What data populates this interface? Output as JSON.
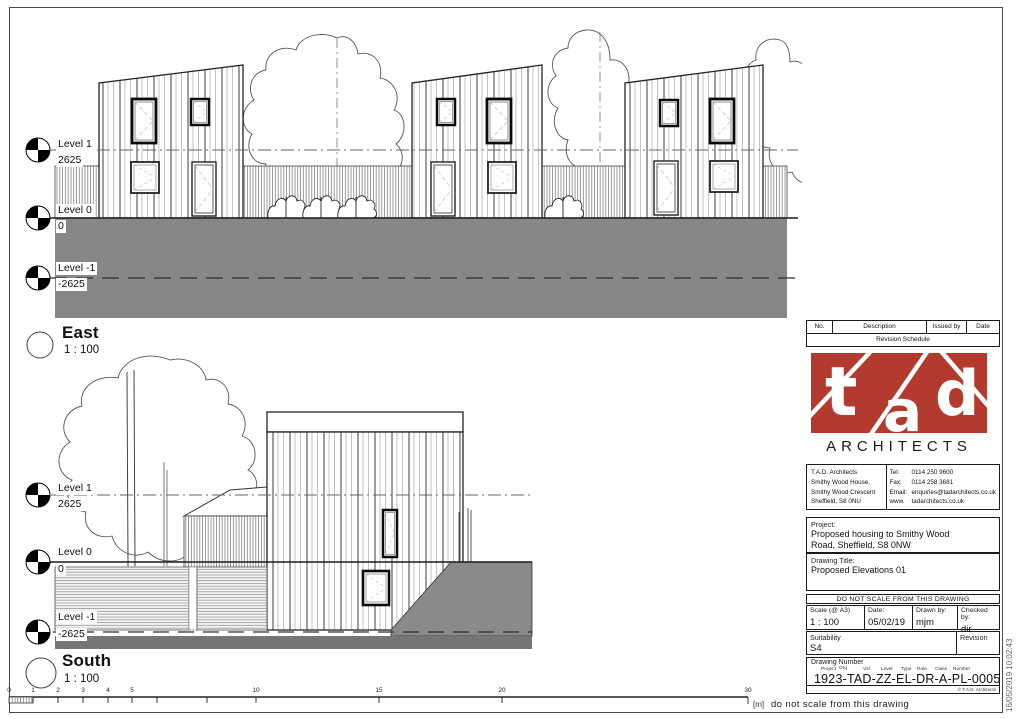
{
  "page": {
    "frame_note_unit": "[m]",
    "frame_note": "do not scale from this drawing",
    "timestamp": "16/05/2019 10:02:43"
  },
  "scalebar": {
    "labels": [
      "0",
      "1",
      "2",
      "3",
      "4",
      "5",
      "10",
      "15",
      "20",
      "30"
    ]
  },
  "views": {
    "east": {
      "title": "East",
      "scale": "1 : 100"
    },
    "south": {
      "title": "South",
      "scale": "1 : 100"
    }
  },
  "levels": [
    {
      "name": "Level 1",
      "value": "2625"
    },
    {
      "name": "Level 0",
      "value": "0"
    },
    {
      "name": "Level -1",
      "value": "-2625"
    }
  ],
  "titleblock": {
    "revision": {
      "col_no": "No.",
      "col_desc": "Description",
      "col_issued": "Issued by",
      "col_date": "Date",
      "subtitle": "Revision Schedule"
    },
    "logo": {
      "t": "t",
      "a": "a",
      "d": "d",
      "word": "ARCHITECTS"
    },
    "contact": {
      "line1": "T.A.D. Architects",
      "line2": "Smithy Wood House,",
      "line3": "Smithy Wood Crescent",
      "line4": "Sheffield, S8 0NU",
      "tel_label": "Tel:",
      "tel": "0114 250 9600",
      "fax_label": "Fax:",
      "fax": "0114 258 3681",
      "email_label": "Email:",
      "email": "enquiries@tadarchitects.co.uk",
      "web_label": "www.",
      "web": "tadarchitects.co.uk"
    },
    "project": {
      "label": "Project:",
      "line1": "Proposed housing to Smithy Wood",
      "line2": "Road, Sheffield, S8 0NW"
    },
    "drawing_title": {
      "label": "Drawing Title:",
      "value": "Proposed Elevations 01"
    },
    "do_not_scale": "DO NOT SCALE FROM THIS DRAWING",
    "meta": {
      "scale_label": "Scale (@ A3)",
      "scale_value": "1 : 100",
      "date_label": "Date:",
      "date_value": "05/02/19",
      "drawn_label": "Drawn by:",
      "drawn_value": "mjm",
      "checked_label": "Checked by:",
      "checked_value": "djr"
    },
    "suitability": {
      "label": "Suitability",
      "value": "S4",
      "revision_label": "Revision",
      "revision_value": ""
    },
    "number": {
      "label": "Drawing Number",
      "f1": "Project",
      "f2": "Org",
      "f3": "Vol",
      "f4": "Level",
      "f5": "Type",
      "f6": "Role",
      "f7": "Class",
      "f8": "Number",
      "value": "1923-TAD-ZZ-EL-DR-A-PL-0005",
      "copyright": "© T.A.D. Architects"
    }
  },
  "colors": {
    "logo_red": "#b23a2e",
    "ground_gray": "#878787",
    "ground_dark": "#757575"
  }
}
